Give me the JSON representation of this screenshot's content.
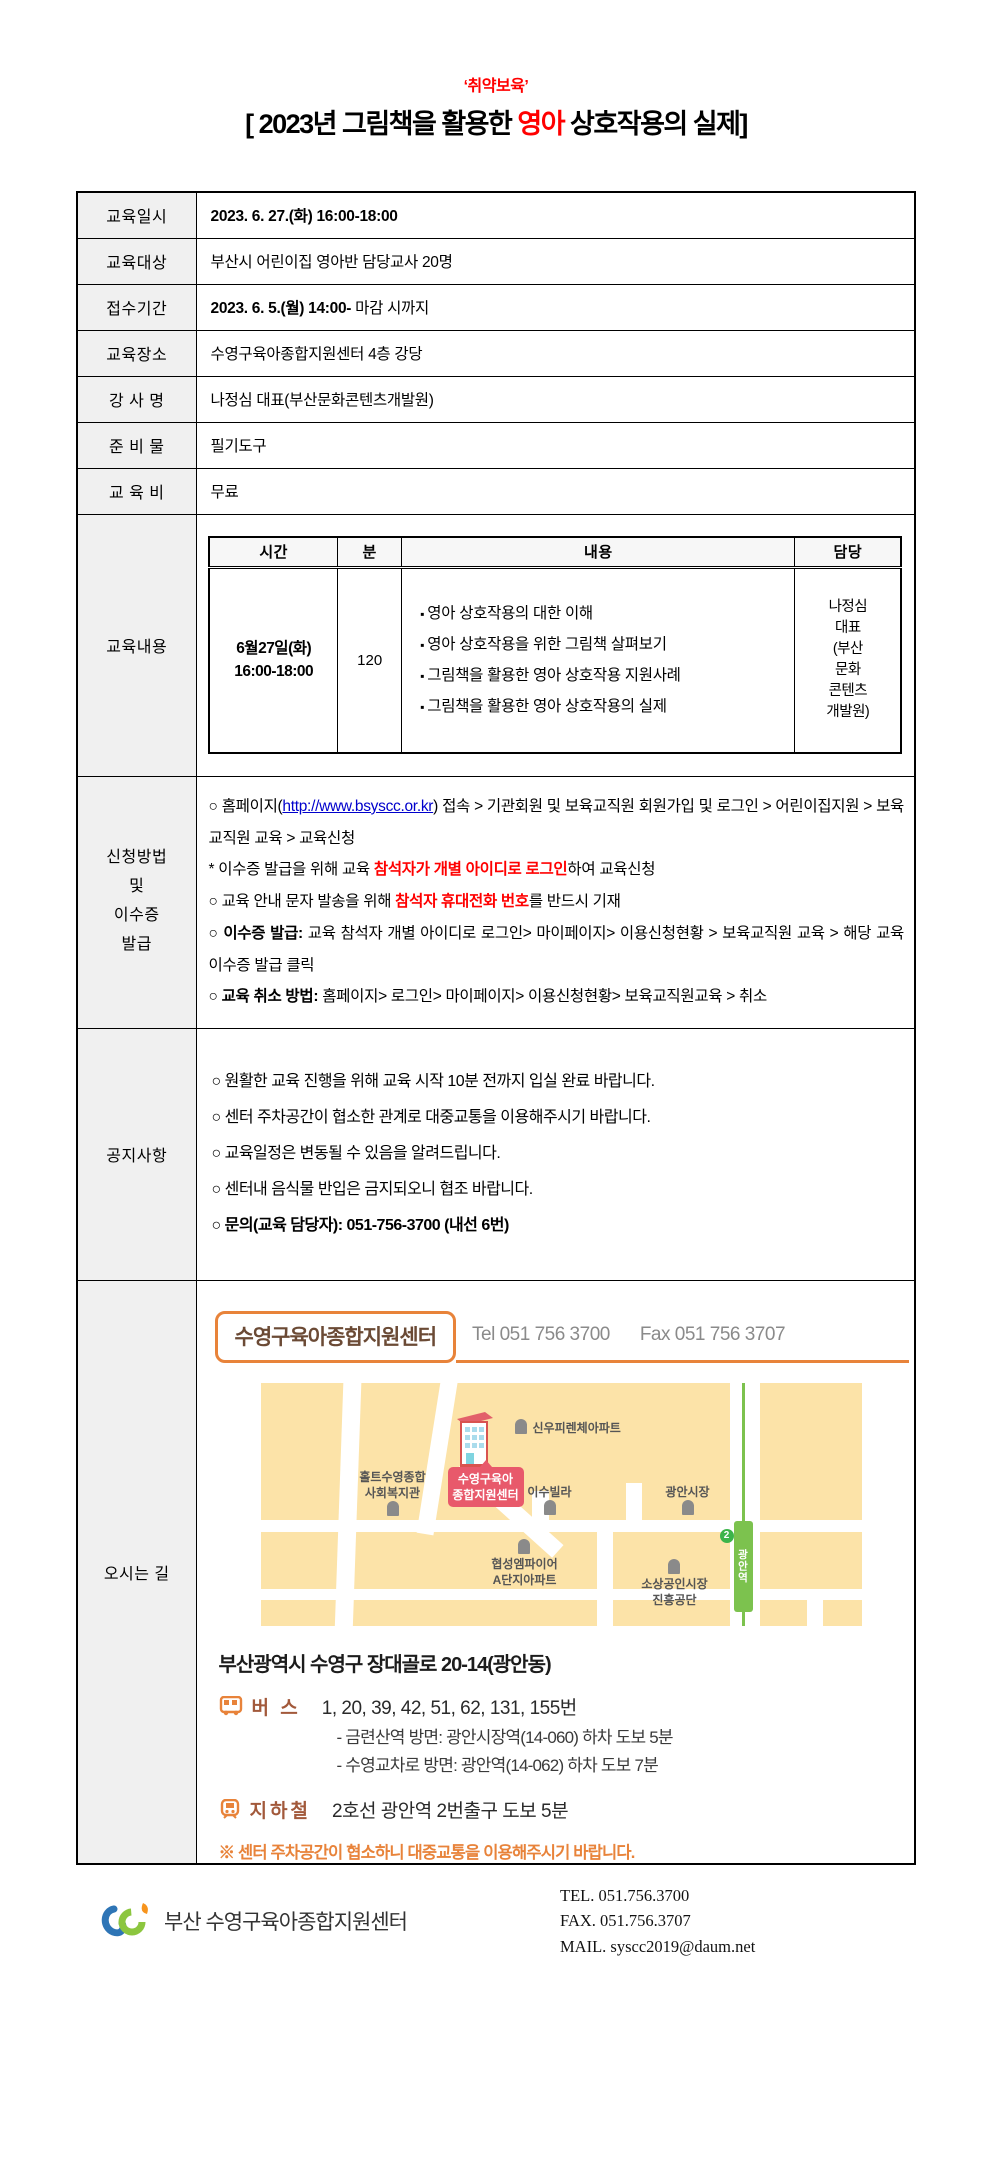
{
  "page": {
    "tagline": "‘취약보육’",
    "title": {
      "prefix": "[ 2023년 그림책을 활용한 ",
      "highlight": "영아",
      "suffix": " 상호작용의 실제]"
    }
  },
  "colors": {
    "accent_red": "#ff0000",
    "link_blue": "#0000cc",
    "orange": "#e8833a",
    "map_bg": "#fce3a8",
    "badge_red": "#e8596b",
    "line_green": "#7cc24e",
    "brown": "#6b4a35"
  },
  "info_rows": [
    {
      "label": "교육일시",
      "bold": "2023. 6. 27.(화) 16:00-18:00",
      "rest": ""
    },
    {
      "label": "교육대상",
      "bold": "",
      "rest": "부산시 어린이집 영아반 담당교사 20명"
    },
    {
      "label": "접수기간",
      "bold": "2023. 6. 5.(월) 14:00-",
      "rest": " 마감 시까지"
    },
    {
      "label": "교육장소",
      "bold": "",
      "rest": "수영구육아종합지원센터 4층 강당"
    },
    {
      "label": "강 사 명",
      "bold": "",
      "rest": "나정심 대표(부산문화콘텐츠개발원)"
    },
    {
      "label": "준 비 물",
      "bold": "",
      "rest": "필기도구"
    },
    {
      "label": "교 육 비",
      "bold": "",
      "rest": "무료"
    }
  ],
  "schedule": {
    "label": "교육내용",
    "headers": [
      "시간",
      "분",
      "내용",
      "담당"
    ],
    "row": {
      "time_line1": "6월27일(화)",
      "time_line2": "16:00-18:00",
      "minutes": "120",
      "bullets": [
        "영아 상호작용의 대한 이해",
        "영아 상호작용을 위한 그림책 살펴보기",
        "그림책을 활용한 영아 상호작용 지원사례",
        "그림책을 활용한 영아 상호작용의 실제"
      ],
      "manager_lines": [
        "나정심",
        "대표",
        "(부산",
        "문화",
        "콘텐츠",
        "개발원)"
      ]
    }
  },
  "apply": {
    "label_lines": [
      "신청방법",
      "및",
      "이수증",
      "발급"
    ],
    "lines": [
      {
        "s1": "○ 홈페이지(",
        "link": "http://www.bsyscc.or.kr",
        "s2": ") 접속 > 기관회원 및 보육교직원 회원가입 및 로그인 > 어린이집지원 > 보육교직원 교육 > 교육신청"
      },
      {
        "s1": "* 이수증 발급을 위해 교육 ",
        "em": "참석자가 개별 아이디로 로그인",
        "s2": "하여 교육신청"
      },
      {
        "s1": "○ 교육 안내 문자 발송을 위해 ",
        "em": "참석자 휴대전화 번호",
        "s2": "를 반드시 기재"
      },
      {
        "s1": "○ ",
        "b": "이수증 발급:",
        "s2": " 교육 참석자 개별 아이디로 로그인> 마이페이지> 이용신청현황 > 보육교직원 교육 > 해당 교육 이수증 발급 클릭"
      },
      {
        "s1": "○ ",
        "b": "교육 취소 방법:",
        "s2": " 홈페이지> 로그인> 마이페이지> 이용신청현황> 보육교직원교육 > 취소"
      }
    ]
  },
  "notices": {
    "label": "공지사항",
    "lines": [
      "○ 원활한 교육 진행을 위해 교육 시작 10분 전까지 입실 완료 바랍니다.",
      "○ 센터 주차공간이 협소한 관계로 대중교통을 이용해주시기 바랍니다.",
      "○ 교육일정은 변동될 수 있음을 알려드립니다.",
      "○ 센터내 음식물 반입은 금지되오니 협조 바랍니다.",
      "○ 문의(교육 담당자): 051-756-3700 (내선 6번)"
    ]
  },
  "directions": {
    "label": "오시는 길",
    "org_name": "수영구육아종합지원센터",
    "tel": "Tel 051 756 3700",
    "fax": "Fax 051 756 3707",
    "map": {
      "sinwoo": "신우피렌체아파트",
      "holt1": "홀트수영종합",
      "holt2": "사회복지관",
      "badge1": "수영구육아",
      "badge2": "종합지원센터",
      "isu": "이수빌라",
      "market": "광안시장",
      "hyupsung1": "협성엠파이어",
      "hyupsung2": "A단지아파트",
      "sosang1": "소상공인시장",
      "sosang2": "진흥공단",
      "station": "광안역",
      "line_no": "2"
    },
    "address": "부산광역시 수영구 장대골로 20-14(광안동)",
    "bus": {
      "label": "버 스",
      "routes": "1, 20, 39, 42, 51, 62, 131, 155번",
      "details": [
        "- 금련산역 방면: 광안시장역(14-060) 하차 도보 5분",
        "- 수영교차로 방면: 광안역(14-062) 하차 도보 7분"
      ]
    },
    "subway": {
      "label": "지하철",
      "text": "2호선 광안역 2번출구 도보 5분"
    },
    "note": "※ 센터 주차공간이 협소하니 대중교통을 이용해주시기 바랍니다."
  },
  "footer": {
    "org": "부산 수영구육아종합지원센터",
    "tel": "TEL. 051.756.3700",
    "fax": "FAX. 051.756.3707",
    "mail": "MAIL. syscc2019@daum.net"
  }
}
